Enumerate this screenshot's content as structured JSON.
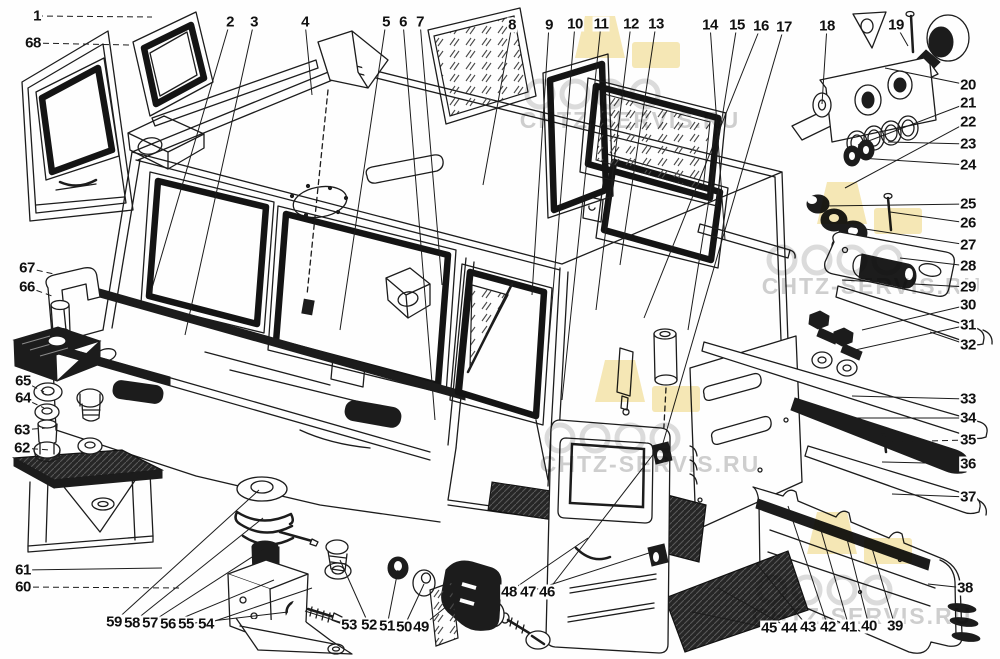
{
  "diagram": {
    "line_color": "#1c1c1c",
    "background_color": "#fefefe",
    "watermark": {
      "text": "CHTZ-SERVIS.RU",
      "logo_color": "#f6e8b6",
      "circle_color": "#dcdcdc",
      "text_color": "#c7c7c7",
      "tiles": [
        {
          "x": 570,
          "y": 16
        },
        {
          "x": 812,
          "y": 182
        },
        {
          "x": 590,
          "y": 360
        },
        {
          "x": 802,
          "y": 512
        }
      ]
    },
    "callouts": [
      {
        "n": "1",
        "x": 37,
        "y": 16,
        "tx": 152,
        "ty": 17,
        "d": true
      },
      {
        "n": "2",
        "x": 230,
        "y": 22,
        "tx": 150,
        "ty": 295
      },
      {
        "n": "3",
        "x": 254,
        "y": 22,
        "tx": 185,
        "ty": 335
      },
      {
        "n": "4",
        "x": 305,
        "y": 22,
        "tx": 312,
        "ty": 95
      },
      {
        "n": "5",
        "x": 386,
        "y": 22,
        "tx": 340,
        "ty": 330
      },
      {
        "n": "6",
        "x": 403,
        "y": 22,
        "tx": 435,
        "ty": 420
      },
      {
        "n": "7",
        "x": 420,
        "y": 22,
        "tx": 442,
        "ty": 285
      },
      {
        "n": "8",
        "x": 512,
        "y": 25,
        "tx": 483,
        "ty": 185
      },
      {
        "n": "9",
        "x": 549,
        "y": 25,
        "tx": 532,
        "ty": 295
      },
      {
        "n": "10",
        "x": 575,
        "y": 24,
        "tx": 548,
        "ty": 352
      },
      {
        "n": "11",
        "x": 601,
        "y": 24,
        "tx": 562,
        "ty": 400
      },
      {
        "n": "12",
        "x": 631,
        "y": 24,
        "tx": 596,
        "ty": 310
      },
      {
        "n": "13",
        "x": 656,
        "y": 24,
        "tx": 620,
        "ty": 265
      },
      {
        "n": "14",
        "x": 710,
        "y": 25,
        "tx": 725,
        "ty": 240
      },
      {
        "n": "15",
        "x": 737,
        "y": 25,
        "tx": 688,
        "ty": 330
      },
      {
        "n": "16",
        "x": 761,
        "y": 26,
        "tx": 644,
        "ty": 318
      },
      {
        "n": "17",
        "x": 784,
        "y": 27,
        "tx": 661,
        "ty": 450
      },
      {
        "n": "18",
        "x": 827,
        "y": 26,
        "tx": 822,
        "ty": 104
      },
      {
        "n": "19",
        "x": 896,
        "y": 25,
        "tx": 908,
        "ty": 46
      },
      {
        "n": "20",
        "x": 968,
        "y": 85,
        "tx": 885,
        "ty": 68
      },
      {
        "n": "21",
        "x": 968,
        "y": 103,
        "tx": 858,
        "ty": 145
      },
      {
        "n": "22",
        "x": 968,
        "y": 122,
        "tx": 845,
        "ty": 188
      },
      {
        "n": "23",
        "x": 968,
        "y": 144,
        "tx": 888,
        "ty": 142
      },
      {
        "n": "24",
        "x": 968,
        "y": 165,
        "tx": 860,
        "ty": 158
      },
      {
        "n": "25",
        "x": 968,
        "y": 204,
        "tx": 822,
        "ty": 206
      },
      {
        "n": "26",
        "x": 968,
        "y": 223,
        "tx": 890,
        "ty": 212
      },
      {
        "n": "27",
        "x": 968,
        "y": 245,
        "tx": 846,
        "ty": 226
      },
      {
        "n": "28",
        "x": 968,
        "y": 266,
        "tx": 900,
        "ty": 258
      },
      {
        "n": "29",
        "x": 968,
        "y": 287,
        "tx": 842,
        "ty": 280
      },
      {
        "n": "30",
        "x": 968,
        "y": 305,
        "tx": 862,
        "ty": 330
      },
      {
        "n": "31",
        "x": 968,
        "y": 325,
        "tx": 846,
        "ty": 352
      },
      {
        "n": "32",
        "x": 968,
        "y": 345,
        "tx": 930,
        "ty": 332
      },
      {
        "n": "33",
        "x": 968,
        "y": 399,
        "tx": 852,
        "ty": 396
      },
      {
        "n": "34",
        "x": 968,
        "y": 418,
        "tx": 856,
        "ty": 418
      },
      {
        "n": "35",
        "x": 968,
        "y": 440,
        "tx": 884,
        "ty": 442,
        "d": true
      },
      {
        "n": "36",
        "x": 968,
        "y": 464,
        "tx": 882,
        "ty": 462
      },
      {
        "n": "37",
        "x": 968,
        "y": 497,
        "tx": 892,
        "ty": 494
      },
      {
        "n": "38",
        "x": 965,
        "y": 588,
        "tx": 928,
        "ty": 584
      },
      {
        "n": "39",
        "x": 895,
        "y": 626,
        "tx": 872,
        "ty": 548
      },
      {
        "n": "40",
        "x": 869,
        "y": 626,
        "tx": 846,
        "ty": 535
      },
      {
        "n": "41",
        "x": 849,
        "y": 627,
        "tx": 818,
        "ty": 520
      },
      {
        "n": "42",
        "x": 828,
        "y": 627,
        "tx": 788,
        "ty": 506
      },
      {
        "n": "43",
        "x": 808,
        "y": 627,
        "tx": 756,
        "ty": 563
      },
      {
        "n": "44",
        "x": 789,
        "y": 628,
        "tx": 718,
        "ty": 588
      },
      {
        "n": "45",
        "x": 769,
        "y": 628,
        "tx": 692,
        "ty": 612
      },
      {
        "n": "46",
        "x": 547,
        "y": 592,
        "tx": 655,
        "ty": 452
      },
      {
        "n": "47",
        "x": 528,
        "y": 592,
        "tx": 652,
        "ty": 552
      },
      {
        "n": "48",
        "x": 509,
        "y": 592,
        "tx": 588,
        "ty": 538
      },
      {
        "n": "49",
        "x": 421,
        "y": 627,
        "tx": 452,
        "ty": 602
      },
      {
        "n": "50",
        "x": 404,
        "y": 627,
        "tx": 424,
        "ty": 584
      },
      {
        "n": "51",
        "x": 387,
        "y": 626,
        "tx": 398,
        "ty": 570
      },
      {
        "n": "52",
        "x": 369,
        "y": 625,
        "tx": 340,
        "ty": 560
      },
      {
        "n": "53",
        "x": 349,
        "y": 625,
        "tx": 305,
        "ty": 611
      },
      {
        "n": "54",
        "x": 206,
        "y": 624,
        "tx": 312,
        "ty": 588
      },
      {
        "n": "55",
        "x": 186,
        "y": 624,
        "tx": 288,
        "ty": 612
      },
      {
        "n": "56",
        "x": 168,
        "y": 624,
        "tx": 274,
        "ty": 580
      },
      {
        "n": "57",
        "x": 150,
        "y": 623,
        "tx": 266,
        "ty": 548
      },
      {
        "n": "58",
        "x": 132,
        "y": 623,
        "tx": 263,
        "ty": 518
      },
      {
        "n": "59",
        "x": 114,
        "y": 622,
        "tx": 259,
        "ty": 490
      },
      {
        "n": "60",
        "x": 23,
        "y": 587,
        "tx": 182,
        "ty": 588,
        "d": true
      },
      {
        "n": "61",
        "x": 23,
        "y": 570,
        "tx": 162,
        "ty": 568
      },
      {
        "n": "62",
        "x": 22,
        "y": 448,
        "tx": 50,
        "ty": 450,
        "d": true
      },
      {
        "n": "63",
        "x": 22,
        "y": 430,
        "tx": 46,
        "ty": 428,
        "d": true
      },
      {
        "n": "64",
        "x": 23,
        "y": 398,
        "tx": 44,
        "ty": 408,
        "d": true
      },
      {
        "n": "65",
        "x": 23,
        "y": 381,
        "tx": 44,
        "ty": 392,
        "d": true
      },
      {
        "n": "66",
        "x": 27,
        "y": 287,
        "tx": 52,
        "ty": 296,
        "d": true
      },
      {
        "n": "67",
        "x": 27,
        "y": 268,
        "tx": 54,
        "ty": 274,
        "d": true
      },
      {
        "n": "68",
        "x": 33,
        "y": 43,
        "tx": 130,
        "ty": 45,
        "d": true
      }
    ]
  }
}
